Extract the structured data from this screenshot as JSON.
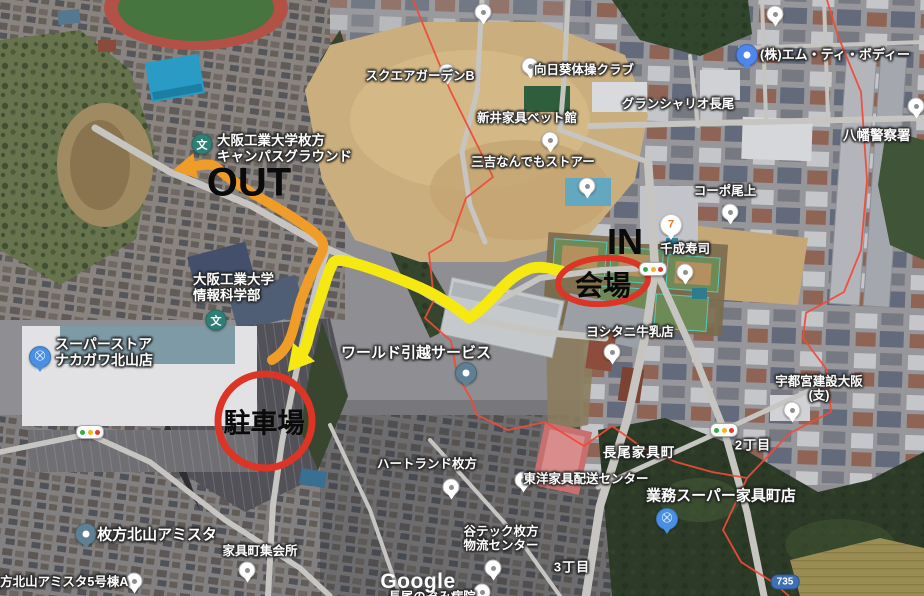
{
  "map": {
    "watermark": "Google",
    "route_shield": {
      "text": "735",
      "x": 785,
      "y": 582
    },
    "labels": [
      {
        "text": "スクエアガーデンB",
        "x": 420,
        "y": 76,
        "size": 12.5,
        "kind": "poi"
      },
      {
        "text": "向日葵体操クラブ",
        "x": 584,
        "y": 70,
        "size": 12.5,
        "kind": "poi"
      },
      {
        "text": "(株)エム・ティ・ボディー",
        "x": 760,
        "y": 48,
        "size": 13,
        "kind": "poi",
        "anchor": "tl"
      },
      {
        "text": "八幡警察署",
        "x": 843,
        "y": 128,
        "size": 13.5,
        "kind": "poi",
        "anchor": "tl"
      },
      {
        "text": "グランシャリオ長尾",
        "x": 678,
        "y": 104,
        "size": 12.5,
        "kind": "poi"
      },
      {
        "text": "新井家具ベット館",
        "x": 527,
        "y": 118,
        "size": 12.5,
        "kind": "poi"
      },
      {
        "text": "三吉なんでもストアー",
        "x": 533,
        "y": 162,
        "size": 12.5,
        "kind": "poi"
      },
      {
        "text": "コーポ尾上",
        "x": 725,
        "y": 191,
        "size": 12.5,
        "kind": "poi"
      },
      {
        "text": "千成寿司",
        "x": 685,
        "y": 249,
        "size": 12.5,
        "kind": "poi"
      },
      {
        "text": "大阪工業大学枚方\nキャンパスグラウンド",
        "x": 217,
        "y": 133,
        "size": 13.5,
        "kind": "poi",
        "anchor": "tl"
      },
      {
        "text": "大阪工業大学\n情報科学部",
        "x": 193,
        "y": 272,
        "size": 13.5,
        "kind": "poi",
        "anchor": "tl"
      },
      {
        "text": "スーパーストア\nナカガワ北山店",
        "x": 55,
        "y": 336,
        "size": 14,
        "kind": "poi",
        "anchor": "tl"
      },
      {
        "text": "ワールド引越サービス",
        "x": 416,
        "y": 353,
        "size": 15,
        "kind": "poi"
      },
      {
        "text": "ヨシタニ牛乳店",
        "x": 630,
        "y": 332,
        "size": 12.5,
        "kind": "poi"
      },
      {
        "text": "宇都宮建設大阪(支)",
        "x": 819,
        "y": 389,
        "size": 12.5,
        "kind": "poi"
      },
      {
        "text": "2丁目",
        "x": 753,
        "y": 446,
        "size": 13,
        "kind": "area"
      },
      {
        "text": "長尾家具町",
        "x": 639,
        "y": 453,
        "size": 13.5,
        "kind": "area"
      },
      {
        "text": "東洋家具配送センター",
        "x": 586,
        "y": 479,
        "size": 12.5,
        "kind": "poi"
      },
      {
        "text": "業務スーパー家具町店",
        "x": 721,
        "y": 496,
        "size": 15,
        "kind": "poi"
      },
      {
        "text": "ハートランド枚方",
        "x": 427,
        "y": 464,
        "size": 12.5,
        "kind": "poi"
      },
      {
        "text": "谷テック枚方\n物流センター",
        "x": 501,
        "y": 539,
        "size": 12.5,
        "kind": "poi"
      },
      {
        "text": "3丁目",
        "x": 572,
        "y": 568,
        "size": 13,
        "kind": "area"
      },
      {
        "text": "枚方北山アミスタ",
        "x": 157,
        "y": 535,
        "size": 15,
        "kind": "poi"
      },
      {
        "text": "枚方北山アミスタ5号棟A",
        "x": 58,
        "y": 582,
        "size": 12.5,
        "kind": "poi"
      },
      {
        "text": "家具町集会所",
        "x": 260,
        "y": 551,
        "size": 12.5,
        "kind": "poi"
      },
      {
        "text": "長尾のぞみ病院",
        "x": 432,
        "y": 597,
        "size": 12.5,
        "kind": "poi"
      }
    ],
    "pins": [
      {
        "kind": "white",
        "x": 483,
        "y": 12
      },
      {
        "kind": "white",
        "x": 775,
        "y": 14
      },
      {
        "kind": "white",
        "x": 447,
        "y": 72
      },
      {
        "kind": "white",
        "x": 530,
        "y": 66
      },
      {
        "kind": "white",
        "x": 916,
        "y": 106
      },
      {
        "kind": "white",
        "x": 550,
        "y": 140
      },
      {
        "kind": "white",
        "x": 587,
        "y": 186
      },
      {
        "kind": "white",
        "x": 730,
        "y": 212
      },
      {
        "kind": "white",
        "x": 685,
        "y": 272
      },
      {
        "kind": "white",
        "x": 612,
        "y": 352
      },
      {
        "kind": "white",
        "x": 792,
        "y": 410
      },
      {
        "kind": "white",
        "x": 523,
        "y": 480
      },
      {
        "kind": "white",
        "x": 451,
        "y": 487
      },
      {
        "kind": "white",
        "x": 493,
        "y": 568
      },
      {
        "kind": "white",
        "x": 482,
        "y": 592
      },
      {
        "kind": "white",
        "x": 134,
        "y": 581
      },
      {
        "kind": "white",
        "x": 247,
        "y": 570
      },
      {
        "kind": "blue",
        "x": 747,
        "y": 55
      },
      {
        "kind": "slate",
        "x": 466,
        "y": 373
      },
      {
        "kind": "slate",
        "x": 86,
        "y": 534
      },
      {
        "kind": "cart",
        "x": 40,
        "y": 357
      },
      {
        "kind": "cart",
        "x": 667,
        "y": 519
      },
      {
        "kind": "seven",
        "x": 671,
        "y": 225
      },
      {
        "kind": "school",
        "x": 202,
        "y": 144
      },
      {
        "kind": "school",
        "x": 216,
        "y": 320
      },
      {
        "kind": "traffic",
        "x": 653,
        "y": 269
      },
      {
        "kind": "traffic",
        "x": 724,
        "y": 430
      },
      {
        "kind": "traffic",
        "x": 90,
        "y": 432
      }
    ]
  },
  "annotations": {
    "in": {
      "text": "IN",
      "x": 625,
      "y": 242,
      "size": 36
    },
    "out": {
      "text": "OUT",
      "x": 249,
      "y": 183,
      "size": 40
    },
    "venue": {
      "text": "会場",
      "x": 603,
      "y": 284,
      "size": 28
    },
    "parking": {
      "text": "駐車場",
      "x": 264,
      "y": 421,
      "size": 27
    },
    "colors": {
      "route_in": "#f6e912",
      "route_out": "#f09c28",
      "marker_red": "#dc3425",
      "text": "#0a0a0a"
    },
    "venue_ellipse": {
      "cx": 603,
      "cy": 281,
      "rx": 45,
      "ry": 23,
      "stroke_width": 6,
      "rotate": -4
    },
    "parking_circle": {
      "cx": 265,
      "cy": 421,
      "r": 47,
      "stroke_width": 7
    },
    "routes": {
      "in_path": "M561,271 C546,267 537,266 529,269 C517,273 507,282 497,293 C486,305 477,313 469,318 C456,308 441,297 421,288 C400,279 372,268 353,263 C345,261 337,258 333,263 C328,272 325,284 321,296 C317,308 313,319 310,331 C307,343 305,351 300,357",
      "out_path": "M272,360 C282,354 288,345 291,336 C296,322 297,312 301,300 C306,286 313,270 321,254 C325,246 324,241 317,235 C308,227 297,220 286,213 L252,193 C237,184 227,177 217,168 C212,163 206,164 190,167",
      "in_width": 11,
      "out_width": 10
    }
  }
}
